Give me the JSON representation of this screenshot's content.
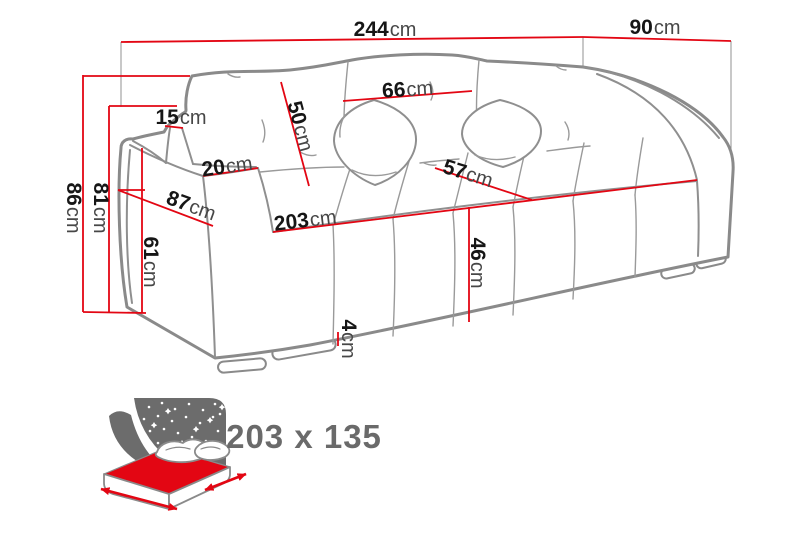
{
  "diagram": {
    "description": "Sofa bed dimension diagram",
    "unit": "cm"
  },
  "dimensions": {
    "overall_width": {
      "value": "244",
      "unit": "cm"
    },
    "overall_depth": {
      "value": "90",
      "unit": "cm"
    },
    "back_cushion_width": {
      "value": "66",
      "unit": "cm"
    },
    "backrest_height": {
      "value": "50",
      "unit": "cm"
    },
    "armrest_back_width": {
      "value": "15",
      "unit": "cm"
    },
    "armrest_front_width": {
      "value": "20",
      "unit": "cm"
    },
    "armrest_depth": {
      "value": "87",
      "unit": "cm"
    },
    "total_height": {
      "value": "86",
      "unit": "cm"
    },
    "arm_height": {
      "value": "81",
      "unit": "cm"
    },
    "armrest_front_height": {
      "value": "61",
      "unit": "cm"
    },
    "seat_width": {
      "value": "203",
      "unit": "cm"
    },
    "seat_depth": {
      "value": "57",
      "unit": "cm"
    },
    "seat_height": {
      "value": "46",
      "unit": "cm"
    },
    "leg_height": {
      "value": "4",
      "unit": "cm"
    }
  },
  "sleeping_area": {
    "label": "203 x 135",
    "icon": "sofa-bed-sleeping-area-icon"
  },
  "colors": {
    "dimension_line": "#e30613",
    "sofa_outline": "#8a8a8a",
    "label_number": "#161616",
    "label_unit": "#474747",
    "icon_gray": "#6c6c6c",
    "sleeping_label_gray": "#6a6a6a",
    "background": "#ffffff"
  }
}
